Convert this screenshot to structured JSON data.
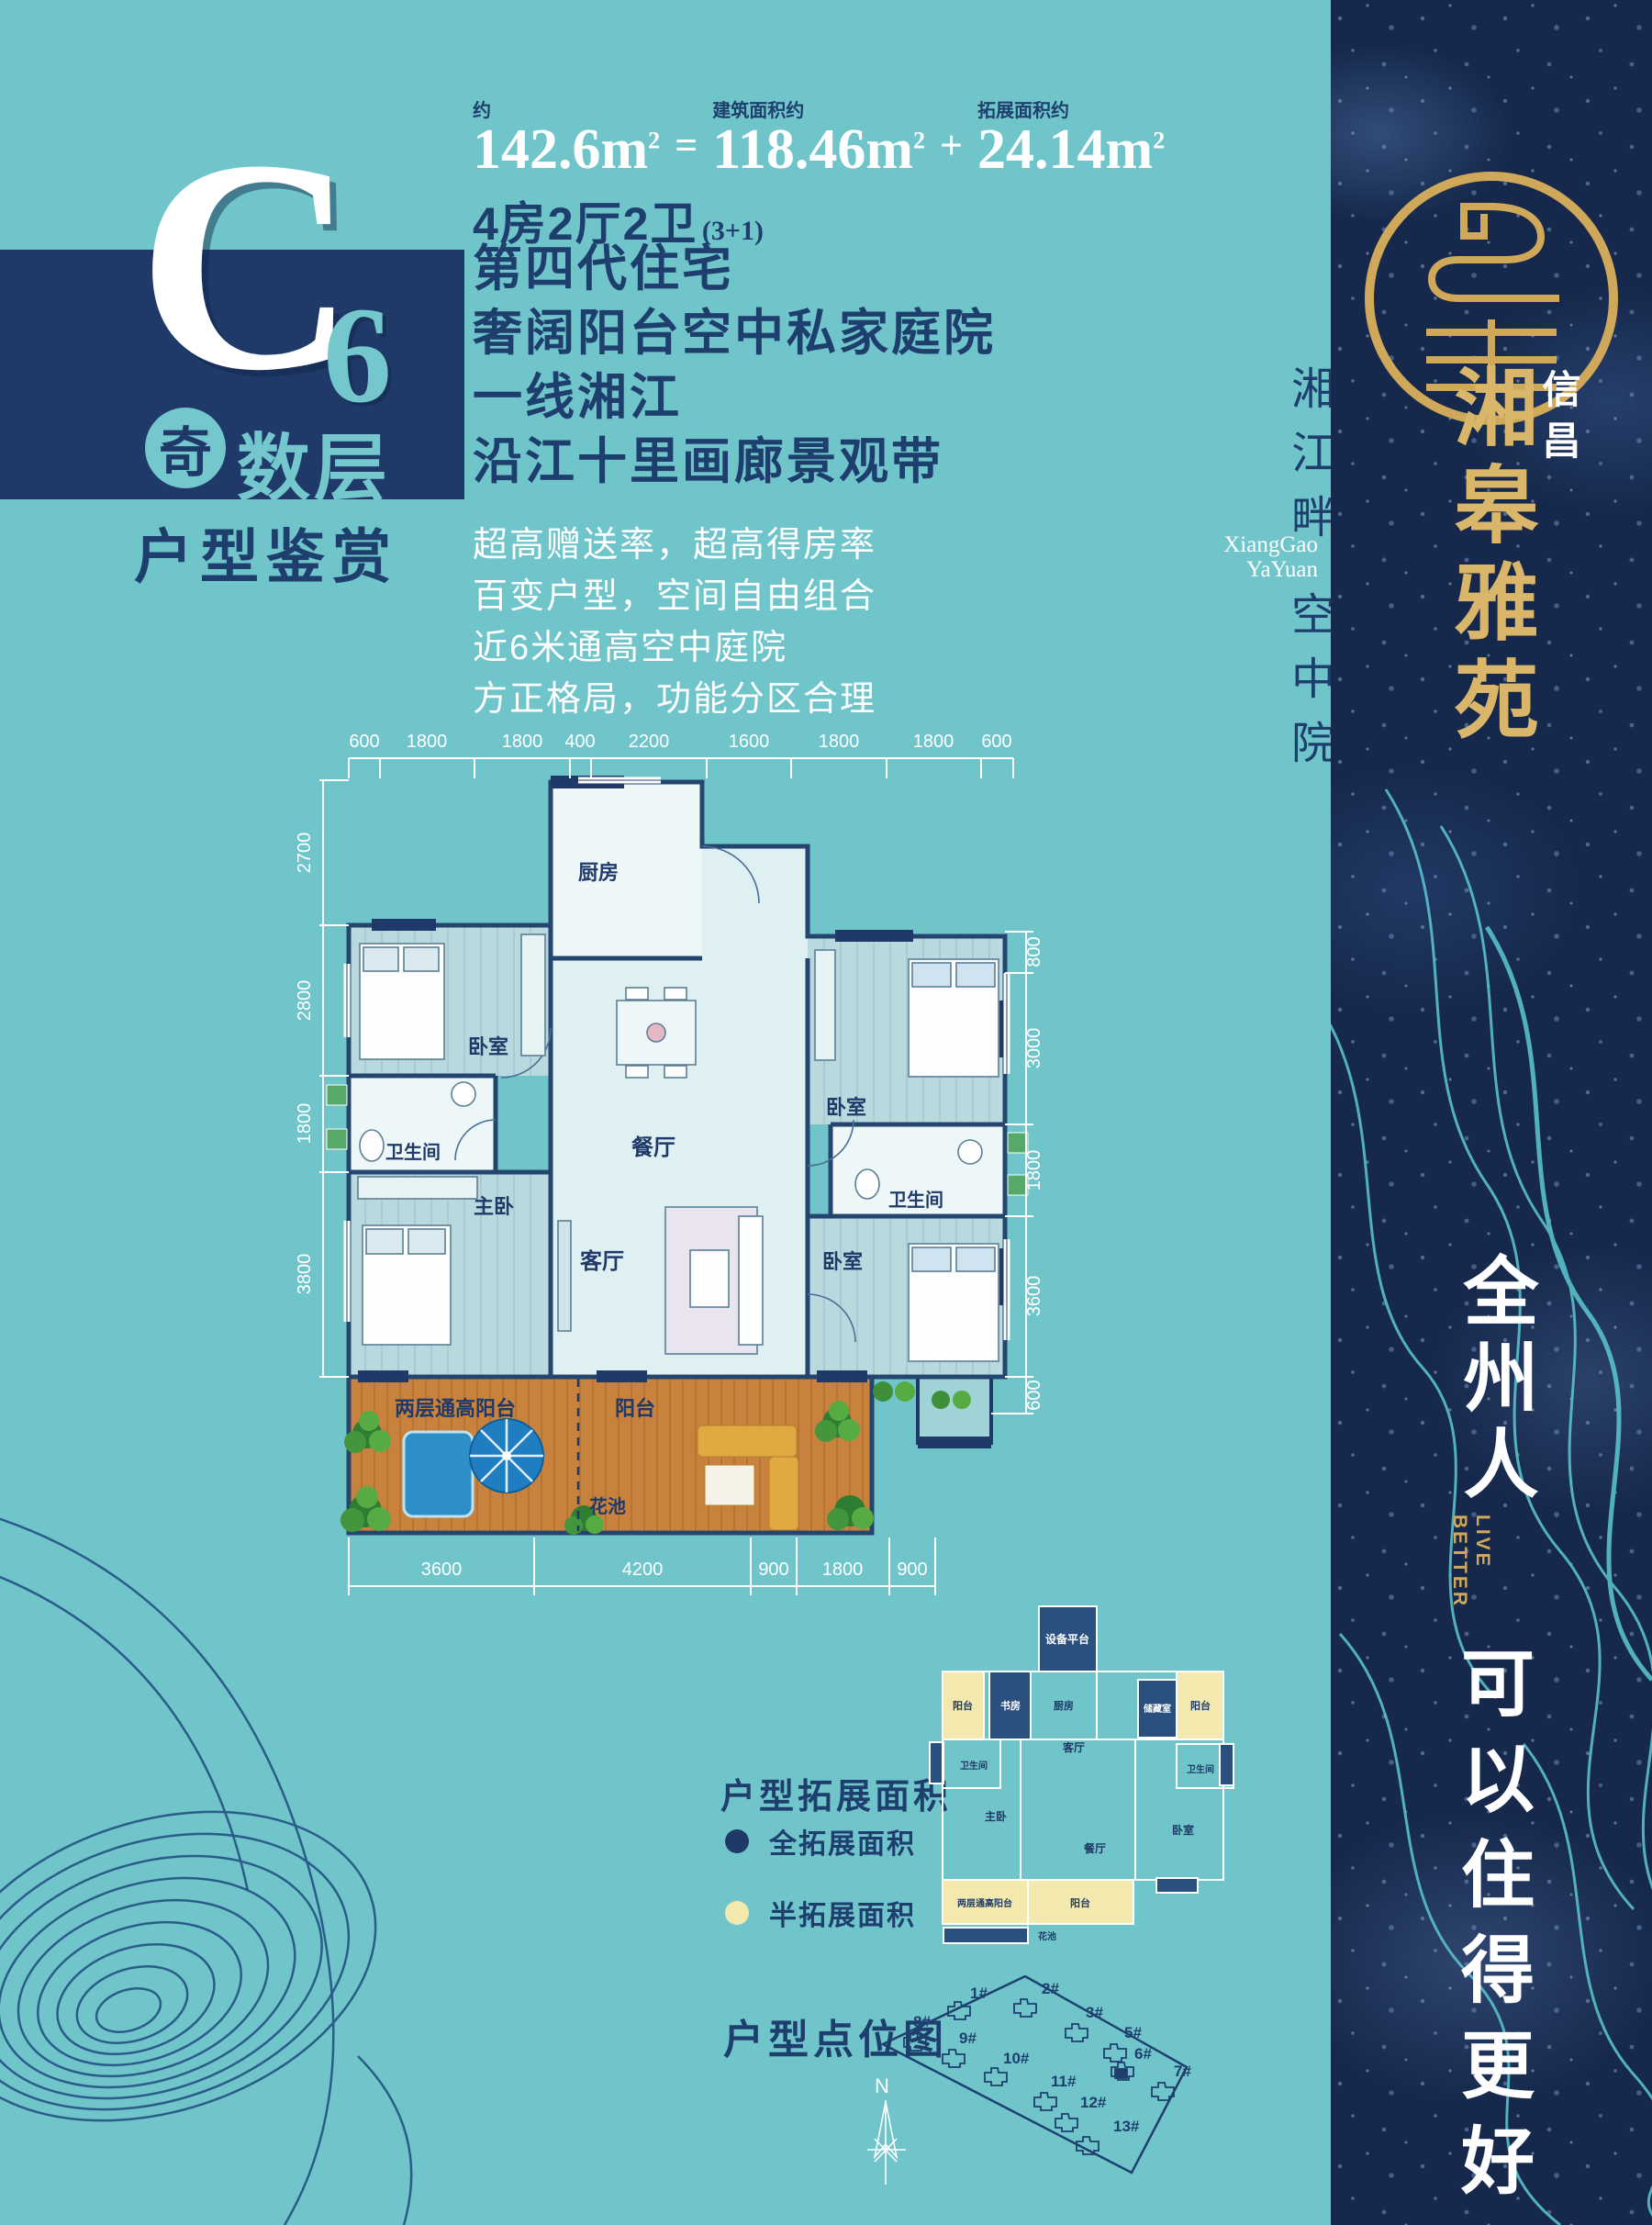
{
  "colors": {
    "teal_bg": "#6fc5ca",
    "navy": "#1f3a68",
    "gold": "#cfa85a",
    "white": "#ffffff",
    "legend_full": "#1f3a68",
    "legend_half": "#f3e9af",
    "deck": "#c9823d",
    "sidebar": "#16294d"
  },
  "header": {
    "letter": "C",
    "number": "6",
    "badge": "奇",
    "badge_suffix": "数层",
    "subtitle": "户型鉴赏"
  },
  "area": {
    "approx_label": "约",
    "total": "142.6m",
    "eq": "=",
    "built_label": "建筑面积约",
    "built": "118.46m",
    "plus": "+",
    "ext_label": "拓展面积约",
    "ext": "24.14m",
    "sup": "2",
    "spec": "4房2厅2卫",
    "spec_note": "(3+1)"
  },
  "headlines": [
    "第四代住宅",
    "奢阔阳台空中私家庭院",
    "一线湘江",
    "沿江十里画廊景观带"
  ],
  "features": [
    "超高赠送率，超高得房率",
    "百变户型，空间自由组合",
    "近6米通高空中庭院",
    "方正格局，功能分区合理"
  ],
  "floorplan": {
    "dims_top": [
      "600",
      "1800",
      "1800",
      "400",
      "2200",
      "1600",
      "1800",
      "1800",
      "600"
    ],
    "dims_left": [
      "2700",
      "2800",
      "1800",
      "3800"
    ],
    "dims_right": [
      "800",
      "3000",
      "1800",
      "3600",
      "600"
    ],
    "dims_bottom": [
      "3600",
      "4200",
      "900",
      "1800",
      "900"
    ],
    "rooms": {
      "kitchen": "厨房",
      "dining": "餐厅",
      "living": "客厅",
      "master": "主卧",
      "bedroom_left": "卧室",
      "bedroom_right_top": "卧室",
      "bedroom_right_bottom": "卧室",
      "bath_left": "卫生间",
      "bath_right": "卫生间",
      "balcony_tall": "两层通高阳台",
      "balcony": "阳台",
      "flower_bed": "花池"
    }
  },
  "legend": {
    "title": "户型拓展面积",
    "full": {
      "label": "全拓展面积",
      "color": "#1f3a68"
    },
    "half": {
      "label": "半拓展面积",
      "color": "#f3e9af"
    }
  },
  "mini_plan": {
    "equipment": "设备平台",
    "balcony_tl": "阳台",
    "study": "书房",
    "kitchen": "厨房",
    "storage": "储藏室",
    "balcony_tr": "阳台",
    "bath_l": "卫生间",
    "living": "客厅",
    "bath_r": "卫生间",
    "master": "主卧",
    "dining": "餐厅",
    "bedroom": "卧室",
    "balcony_tall": "两层通高阳台",
    "balcony_b": "阳台",
    "flower": "花池"
  },
  "site_map": {
    "title": "户型点位图",
    "compass": "N",
    "buildings": [
      "1#",
      "2#",
      "3#",
      "5#",
      "6#",
      "7#",
      "8#",
      "9#",
      "10#",
      "11#",
      "12#",
      "13#"
    ]
  },
  "sidebar": {
    "brand_small": "信昌",
    "brand": "湘皋雅苑",
    "slogan_cn_top": "全州人",
    "slogan_en_1": "LIVE",
    "slogan_en_2": "BETTER",
    "slogan_cn_bottom": "可以住得更好"
  },
  "strip": {
    "l1": "湘江畔",
    "l2": "空中院",
    "en1": "XiangGao",
    "en2": "YaYuan"
  }
}
